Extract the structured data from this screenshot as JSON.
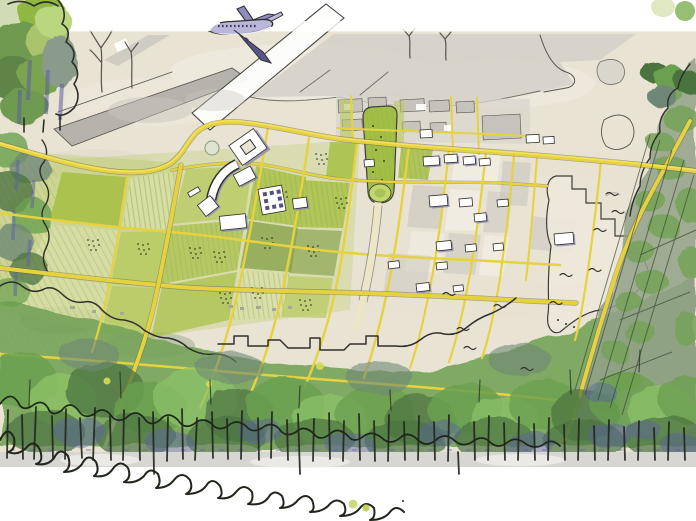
{
  "page": {
    "type": "presentation-slide",
    "background": "#ffffff"
  },
  "illustration": {
    "description": "Hand-drawn aerial watercolour masterplan sketch: an airliner lifts off over airport runways at top, a tilted yellow street grid with green blocks and small white buildings fills the centre, a long green mall with an oval lawn anchors the plan, and dense sketched tree belts frame the left, right and bottom edges",
    "airplane_label": "sketched airliner taking off",
    "airport_label": "runways, taxiways and aprons",
    "road_network_label": "yellow street grid",
    "green_mall_label": "central green mall with oval lawn",
    "campus_label": "white campus buildings with arc building",
    "fields_label": "green fields and orchard blocks",
    "forest_label": "bottom tree belt with trunks",
    "corridor_label": "wooded corridor along southeast road",
    "zone_label": "cleared stepped parcel",
    "dots_label": "green accent dots",
    "birds_label": "bird marks"
  },
  "colors": {
    "paper": "#e9e3d4",
    "paper_light": "#f1ede2",
    "apron_gray": "#d3d0c8",
    "runway_gray": "#b6b3ac",
    "runway_white": "#fdfdfb",
    "outline_ink": "#2f2f2b",
    "outline_soft": "#55544c",
    "road_yellow": "#e6d23f",
    "road_yellow_bright": "#f3e464",
    "road_pale": "#ece6c6",
    "field_green": "#b7ca5e",
    "field_green_bright": "#a6c043",
    "field_green_pale": "#d8e0a8",
    "orchard_dark": "#7d9c3f",
    "row_green": "#93a94f",
    "mall_green": "#a2bf45",
    "mall_oval": "#c4d66e",
    "forest_green": "#74a258",
    "forest_green_mid": "#6aa04f",
    "forest_green_bright": "#8cc267",
    "forest_green_dark": "#4c7340",
    "forest_sage": "#6e8874",
    "corridor_sage": "#93a189",
    "forest_ink": "#20261c",
    "shadow_purple": "#8b87b8",
    "deep_purple": "#5a61a3",
    "building_white": "#ffffff",
    "building_gray": "#c6c3bc",
    "plane_light": "#bab6d9",
    "plane_mid": "#8f8ac0",
    "plane_dark": "#57538b",
    "ground_gray": "#d8d6d2",
    "pond_fill": "#dfe3d2",
    "zone_fill": "#ede8da",
    "dot_pale": "#dfe8c2",
    "dot_green": "#97bf74",
    "dot_yellow_green_1": "#ccd97d",
    "dot_yellow_green_2": "#c3d25b",
    "speck_dark": "#4a4a46",
    "glow_yellow": "#d6dd55"
  }
}
